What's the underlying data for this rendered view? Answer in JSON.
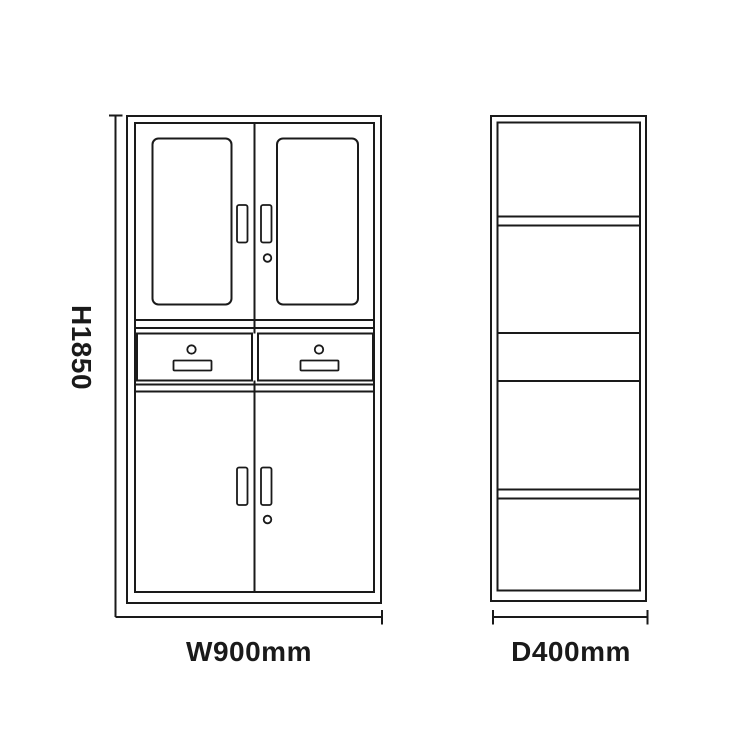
{
  "diagram": {
    "labels": {
      "height": "H1850",
      "width": "W900mm",
      "depth": "D400mm"
    }
  },
  "colors": {
    "line": "#1a1a1a",
    "background": "#ffffff"
  }
}
